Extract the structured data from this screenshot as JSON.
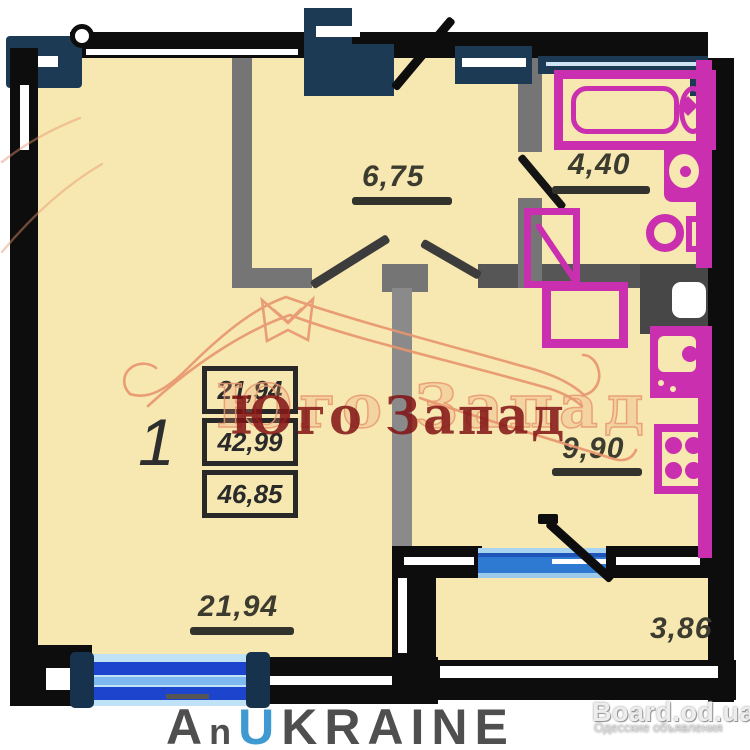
{
  "plan": {
    "rooms": [
      {
        "name": "living-room",
        "area": "21,94"
      },
      {
        "name": "hallway",
        "area": "6,75"
      },
      {
        "name": "bathroom",
        "area": "4,40"
      },
      {
        "name": "kitchen",
        "area": "9,90"
      },
      {
        "name": "balcony",
        "area": "3,86"
      }
    ],
    "summary": {
      "rooms_count": "1",
      "living_area": "21,94",
      "area_mid": "42,99",
      "total_area": "46,85"
    }
  },
  "watermarks": {
    "agency_name": "Юго Запад",
    "portal": {
      "a": "A",
      "n": "n",
      "u": "U",
      "krane": "KRAINE"
    },
    "board_title": "Board.od.ua",
    "board_subtitle": "Одесские объявления"
  },
  "colors": {
    "floor_cream": "#f7e7b0",
    "wall_black": "#0d0d0d",
    "wall_navy": "#1c3a53",
    "wall_gray": "#757575",
    "fixture_magenta": "#c92fae",
    "window_blue": "#2e7ad2",
    "agency_red": "#801214",
    "watermark_salmon": "#e8956e"
  }
}
